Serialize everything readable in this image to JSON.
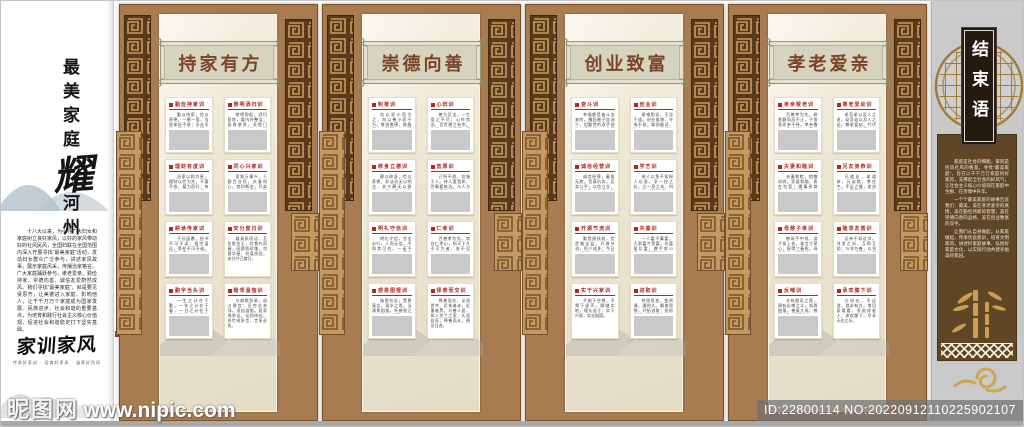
{
  "left_panel": {
    "title_top": "最美家庭",
    "title_big": "耀",
    "title_bottom": "河州",
    "intro": "十八大以来，为引导广大妇女和家庭树立良好家风，以好的家风带动好的社风民风，全国妇联在全国范围内深入开展寻找“最美家庭”活动，发动妇女群众广泛参与，讲述家风故事，展示家庭风采，传播治家格言。广大家庭踊跃参与，孝老爱亲、勤俭持家、崇德向善、诚信友爱蔚然成风。我们寻找“最美家庭”，就是要见贤思齐，让美德进入家庭、影响他人，让千千万万个家庭成为国家发展、民族进步、社会和谐的重要基点，为培育和践行社会主义核心价值观、促进社会和谐稳定打下坚实基础。",
    "logo": "家训家风",
    "logo_sub": "传承好家训 · 培育好家风 · 涵养好民风"
  },
  "panels": [
    {
      "title": "持家有方",
      "cards": [
        {
          "title": "勤俭持家训",
          "body": "勤以持家，俭以养德。一粥一饭，当思来处不易；半丝半缕，恒念物力维艰。量入为出，细水长流。",
          "img": true
        },
        {
          "title": "黎明洒扫训",
          "body": "黎明即起，洒扫庭除，要内外整洁；既昏便息，关锁门户，必亲自检点。居家有度，处世有方。",
          "img": true
        },
        {
          "title": "理财有度训",
          "body": "治家以和为贵，理财以俭为先。不奢不吝，量力而行；有计有划，持之以恒，家道自然兴旺。",
          "img": true
        },
        {
          "title": "同心兴家训",
          "body": "家和万事兴，人勤百业旺。夫妻同心，其利断金；兄弟协力，守望相助，勠力同心共兴家业。",
          "img": true
        },
        {
          "title": "耕读传家训",
          "body": "子孙虽愚，经书不可不读；祖宗虽远，祭祀不可不诚。耕读传家久，诗书继世长。",
          "img": true
        },
        {
          "title": "安分度日训",
          "body": "器具质而洁，瓦缶胜金玉；饮食约而精，园蔬愈珍馐。勿营华屋，勿谋良田，安分守己度日。",
          "img": false
        },
        {
          "title": "勤字当头训",
          "body": "一生之计在于勤，一年之计在于春，一日之计在于寅。早起三光，迟起三慌，勤字当头家业昌。",
          "img": true
        },
        {
          "title": "睦邻温恤训",
          "body": "与肩挑贸易，毋占便宜；见穷苦亲邻，须加温恤。居家戒争讼，讼则终凶；处世戒多言，言多必失。",
          "img": false
        }
      ]
    },
    {
      "title": "崇德向善",
      "cards": [
        {
          "title": "积善训",
          "body": "勿以恶小而为之，勿以善小而不为。惟贤惟德，能服于人。日行一善，积善成德，善行天下。",
          "img": true
        },
        {
          "title": "心田训",
          "body": "善为至宝，一生用之不尽；心作良田，百世耕之有余。存好心，说好话，行好事，做好人。",
          "img": true
        },
        {
          "title": "修身立德训",
          "body": "静以修身，俭以养德。非淡泊无以明志，非宁静无以致远。修身立德，方能行稳致远。",
          "img": true
        },
        {
          "title": "宽厚训",
          "body": "己所不欲，勿施于人。待人要宽和，世事要练达。与人为善，于己为善；与人有路，于己有退。",
          "img": true
        },
        {
          "title": "明礼守信训",
          "body": "明礼守信，言出必行。人而无信，不知其可也。一诺千金，诚信为本，童叟无欺。",
          "img": true
        },
        {
          "title": "仁孝训",
          "body": "百善孝为先。常存仁孝心，则天下凡不可为者，皆不忍为。仁爱存心，善念常在。",
          "img": true
        },
        {
          "title": "感恩图报训",
          "body": "施恩勿念，受恩莫忘。滴水之恩，当涌泉相报。怀感恩之心，行仁义之事。",
          "img": true
        },
        {
          "title": "择善而交训",
          "body": "择善而交，见贤思齐。近朱者赤，近墨者黑。与善人居，如入芝兰之室，久而自芳；择善而从，德业日进。",
          "img": false
        }
      ]
    },
    {
      "title": "创业致富",
      "cards": [
        {
          "title": "奋斗训",
          "body": "幸福都是奋斗出来的。撸起袖子加油干，用勤劳的双手创造美好生活，走共同富裕之路。",
          "img": true
        },
        {
          "title": "创业训",
          "body": "艰难困苦，玉汝于成。创业维艰，守成不易；敢闯敢试，敢为人先，方能闯出一片新天地。",
          "img": true
        },
        {
          "title": "诚信经营训",
          "body": "诚信经营，童叟无欺。货真价实，买卖公平；以信立业，以质取胜，生意自然兴隆。",
          "img": true
        },
        {
          "title": "学艺训",
          "body": "授人以鱼不如授人以渔。学一技之长，立一身之本；科技兴业，知识致富。",
          "img": true
        },
        {
          "title": "开源节流训",
          "body": "勤是摇钱树，俭是聚宝盆。开源节流，积少成多；今日之积累，明日之根基。",
          "img": true
        },
        {
          "title": "共富训",
          "body": "一人富不算富，大家富才是富。先富帮后富，携手奔小康，共同富裕路上一个都不能少。",
          "img": true
        },
        {
          "title": "实干兴家训",
          "body": "不驰于空想，不骛于虚声。脚踏实地，埋头苦干；实干兴家，实业报国。",
          "img": false
        },
        {
          "title": "进取训",
          "body": "穷则思变，变则通，通则久。解放思想，开拓进取；抢抓机遇，乘势而上，奋楫者先。",
          "img": true
        }
      ]
    },
    {
      "title": "孝老爱亲",
      "cards": [
        {
          "title": "孝亲敬老训",
          "body": "百善孝为先。树欲静而风不止，子欲养而亲不待。孝亲敬老，及时行孝，莫待空悲切。",
          "img": true
        },
        {
          "title": "尊老爱幼训",
          "body": "老吾老以及人之老，幼吾幼以及人之幼。尊老爱幼，代代相传，中华美德，永驻心间。",
          "img": true
        },
        {
          "title": "夫妻和睦训",
          "body": "夫妻和睦，相敬如宾。家庭和顺，贵在包容；遇事多商量，有话好好说。",
          "img": true
        },
        {
          "title": "兄友弟恭训",
          "body": "兄道友，弟道恭，兄弟睦，孝在中。手足之情，血浓于水；互帮互让，和气满堂。",
          "img": true
        },
        {
          "title": "母慈子孝训",
          "body": "慈母手中线，游子身上衣。谁言寸草心，报得三春晖。母慈子孝，其乐融融。",
          "img": true
        },
        {
          "title": "睦邻友善训",
          "body": "远亲不如近邻。邻里之间，互帮互助；与邻为善，以邻为伴，守望相助一家亲。",
          "img": true
        },
        {
          "title": "反哺训",
          "body": "羊有跪乳之恩，鸦有反哺之义。知恩图报，善莫大焉；感恩父母，回报社会。",
          "img": true
        },
        {
          "title": "承欢膝下训",
          "body": "父母在，不远游，游必有方。常回家看看，多陪伴老人；承欢膝下，尽享天伦之乐。",
          "img": false
        }
      ]
    }
  ],
  "end_panel": {
    "title": "结束语",
    "paragraphs": [
      "家庭是社会的细胞，家风是民风社风的根基。寻找“最美家庭”，旨在以千千万万家庭的好家风，支撑起全社会的好风气，让社会主义核心价值观在家庭中生根、在亲情中升华。",
      "一个个最美家庭的故事告诉我们：最美，美在孝老爱亲的真情，美在勤俭持家的智慧，美在崇德向善的品格，美在创业致富的双手。",
      "让我们从自身做起，从家庭做起，传承优良家训，培育文明家风，讲述好家庭故事、弘扬好家庭文化，以实际行动共建幸福美好家园。"
    ]
  },
  "watermark": {
    "site": "昵图网",
    "url": "www.nipic.com",
    "id_line": "ID:22800114 NO:20220912110225902107"
  },
  "colors": {
    "frame_brown": "#a87c50",
    "dark_strip": "#593a1d",
    "gold": "#c89a5c",
    "cream": "#ece5d2",
    "accent_red": "#b3271e",
    "plaque_green": "#d6d3bf",
    "end_gray": "#c8c8ca",
    "end_box_brown": "#5f4626"
  }
}
